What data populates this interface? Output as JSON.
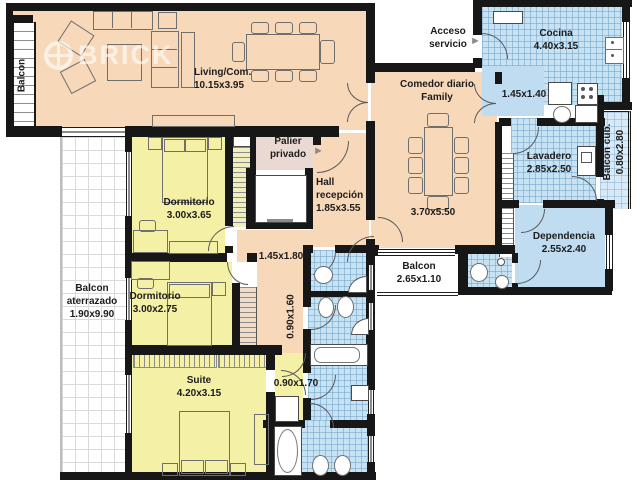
{
  "brand": {
    "watermark": "BRICK"
  },
  "colors": {
    "peach": "#f7d8b9",
    "yellow": "#f4f0a6",
    "wet": "#c7e2f3",
    "wet_flat": "#bfdcf0",
    "wet_light": "#d8eaf7",
    "palier": "#ead9d2",
    "closet": "#f0dcc8",
    "stairs": "#f1eebf",
    "wall": "#171717",
    "label": "#1c1c1c"
  },
  "labels": {
    "balcon_top_left": {
      "name": "Balcon"
    },
    "living": {
      "name": "Living/Com.",
      "dims": "10.15x3.95"
    },
    "acceso": {
      "line1": "Acceso",
      "line2": "servicio"
    },
    "cocina": {
      "name": "Cocina",
      "dims": "4.40x3.15"
    },
    "comedor": {
      "line1": "Comedor diario",
      "line2": "Family",
      "dims": "3.70x5.50"
    },
    "paso_cocina": {
      "dims": "1.45x1.40"
    },
    "lavadero": {
      "name": "Lavadero",
      "dims": "2.85x2.50"
    },
    "balcon_cubierto": {
      "name": "Balcon cub.",
      "dims": "0.80x2.80"
    },
    "palier": {
      "line1": "Palier",
      "line2": "privado"
    },
    "hall": {
      "line1": "Hall",
      "line2": "recepción",
      "dims": "1.85x3.55"
    },
    "dormitorio_1": {
      "name": "Dormitorio",
      "dims": "3.00x3.65"
    },
    "paso_hall": {
      "dims": "1.45x1.80"
    },
    "dependencia": {
      "name": "Dependencia",
      "dims": "2.55x2.40"
    },
    "balcon_servicio": {
      "name": "Balcon",
      "dims": "2.65x1.10"
    },
    "balcon_aterrazado": {
      "line1": "Balcon",
      "line2": "aterrazado",
      "dims": "1.90x9.90"
    },
    "dormitorio_2": {
      "name": "Dormitorio",
      "dims": "3.00x2.75"
    },
    "paso_dormitorios": {
      "dims": "0.90x1.60"
    },
    "suite": {
      "name": "Suite",
      "dims": "4.20x3.15"
    },
    "paso_suite": {
      "dims": "0.90x1.70"
    }
  },
  "icons": {
    "arrow_right": "►"
  }
}
